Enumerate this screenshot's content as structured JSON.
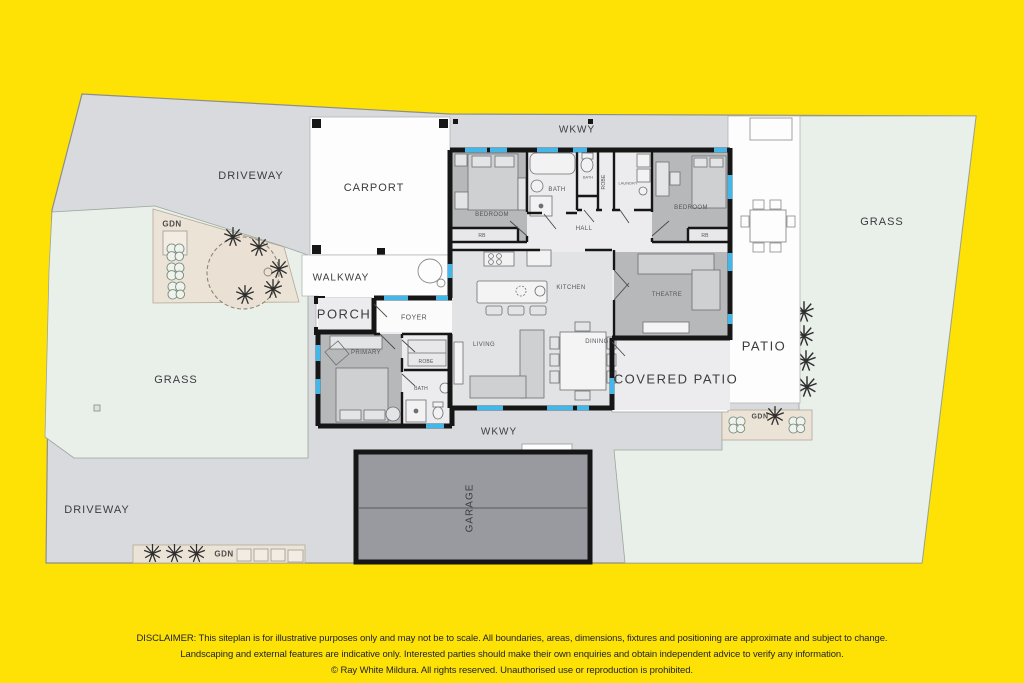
{
  "site": {
    "outdoor_labels": {
      "driveway_top": "DRIVEWAY",
      "carport": "CARPORT",
      "wkwy_top": "WKWY",
      "gdn_top": "GDN",
      "walkway": "WALKWAY",
      "porch": "PORCH",
      "grass_left": "GRASS",
      "driveway_bottom": "DRIVEWAY",
      "gdn_bottom": "GDN",
      "wkwy_bottom": "WKWY",
      "garage": "GARAGE",
      "covered_patio": "COVERED PATIO",
      "patio": "PATIO",
      "gdn_right": "GDN",
      "grass_right": "GRASS"
    },
    "room_labels": {
      "bedroom_left": "BEDROOM",
      "rb_left": "RB",
      "bath_main": "BATH",
      "wc": "BATH",
      "robe_hall": "ROBE",
      "laundry": "LAUNDRY",
      "bedroom_right": "BEDROOM",
      "rb_right": "RB",
      "hall": "HALL",
      "kitchen": "KITCHEN",
      "theatre": "THEATRE",
      "living": "LIVING",
      "dining": "DINING",
      "foyer": "FOYER",
      "primary": "PRIMARY",
      "robe_primary": "ROBE",
      "bath_primary": "BATH"
    }
  },
  "disclaimer": {
    "line1": "DISCLAIMER: This siteplan is for illustrative purposes only and may not be to scale. All boundaries, areas, dimensions, fixtures and positioning are approximate and subject to change.",
    "line2": "Landscaping and external features are indicative only. Interested parties should make their own enquiries and obtain independent advice to verify any information.",
    "line3": "© Ray White Mildura. All rights reserved. Unauthorised use or reproduction is prohibited."
  },
  "colors": {
    "background": "#FFE205",
    "paving_gray": "#d8dadd",
    "grass_green": "#e9efe9",
    "garden_beige": "#ece3d7",
    "house_floor": "#ececee",
    "open_plan_floor": "#e2e3e5",
    "bedroom_gray": "#b7b8ba",
    "garage_gray": "#989aa0",
    "wall_black": "#161616",
    "window_blue": "#45b6e8",
    "white_area": "#fdfdfd"
  }
}
